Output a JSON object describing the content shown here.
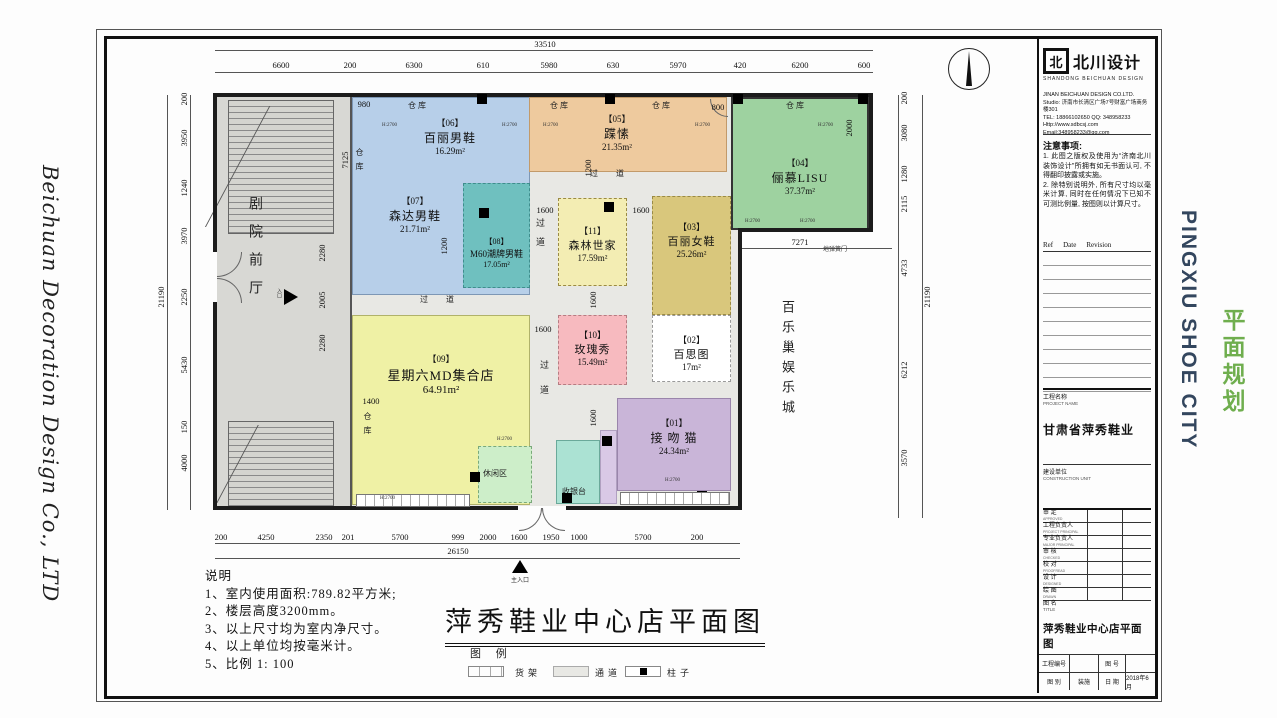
{
  "side_left": {
    "company": "Beichuan Decoration Design Co., LTD"
  },
  "side_right": {
    "city": "PINGXIU SHOE CITY",
    "city_color": "#33465e",
    "plan": "平面规划",
    "plan_color": "#6fae4e"
  },
  "titleblock": {
    "logo_glyph": "北",
    "logo_name": "北川设计",
    "logo_sub": "SHANDONG BEICHUAN DESIGN",
    "address": [
      "JINAN BEICHUAN DESIGN CO.LTD.",
      "Studio: 济南市长清区广场7号财富广场商务楼301",
      "TEL: 18866102650   QQ: 348958233",
      "Http://www.sdbcsj.com",
      "Email:348958233@qq.com"
    ],
    "caution_title": "注意事项:",
    "caution_1": "1. 此图之版权及使用为“济南北川装饰设计”所拥有如无书面认可, 不得翻印披露或实施。",
    "caution_2": "2. 除特别说明外, 所有尺寸均以毫米计算, 同时在任何情况下已知不可测比例量, 按图则以计算尺寸。",
    "rev_ref": "Ref",
    "rev_date": "Date",
    "rev_revision": "Revision",
    "project_label": "工程名称",
    "project_label_en": "PROJECT NAME",
    "project_name": "甘肃省萍秀鞋业",
    "client_label": "建设单位",
    "client_label_en": "CONSTRUCTION UNIT",
    "rows": [
      {
        "label": "审  定",
        "en": "APPROVED"
      },
      {
        "label": "工程负责人",
        "en": "PROJECT PRINCIPAL"
      },
      {
        "label": "专业负责人",
        "en": "MAJOR PRINCIPAL"
      },
      {
        "label": "审  核",
        "en": "CHECKED"
      },
      {
        "label": "校  对",
        "en": "PROOFREAD"
      },
      {
        "label": "设  计",
        "en": "DESIGNED"
      },
      {
        "label": "绘  图",
        "en": "DRAWN"
      }
    ],
    "fig_label": "图 名",
    "fig_label_en": "TITLE",
    "fig_name": "萍秀鞋业中心店平面图",
    "proj_no_label": "工程编号",
    "fig_no_label": "图 号",
    "cat_label": "图 别",
    "cat_value": "装施",
    "date_label": "日 期",
    "date_value": "2018年6月"
  },
  "plan": {
    "rooms": [
      {
        "no": "【01】",
        "name": "接 吻 猫",
        "area": "24.34m²",
        "color": "#c9b5d8"
      },
      {
        "no": "【02】",
        "name": "百思图",
        "area": "17m²",
        "color": "#ffffff"
      },
      {
        "no": "【03】",
        "name": "百丽女鞋",
        "area": "25.26m²",
        "color": "#d9c77c"
      },
      {
        "no": "【04】",
        "name": "俪慕LISU",
        "area": "37.37m²",
        "color": "#9ed2a0"
      },
      {
        "no": "【05】",
        "name": "蹀愫",
        "area": "21.35m²",
        "color": "#eeca9e"
      },
      {
        "no": "【06】",
        "name": "百丽男鞋",
        "area": "16.29m²",
        "color": "#b7cfe9"
      },
      {
        "no": "【07】",
        "name": "森达男鞋",
        "area": "21.71m²",
        "color": "#b7cfe9"
      },
      {
        "no": "【08】",
        "name": "M60潮牌男鞋",
        "area": "17.05m²",
        "color": "#6fc0bf"
      },
      {
        "no": "【09】",
        "name": "星期六MD集合店",
        "area": "64.91m²",
        "color": "#eff1a5"
      },
      {
        "no": "【10】",
        "name": "玫瑰秀",
        "area": "15.49m²",
        "color": "#f7babf"
      },
      {
        "no": "【11】",
        "name": "森林世家",
        "area": "17.59m²",
        "color": "#f3edb3"
      }
    ],
    "labels": {
      "warehouse": "仓库",
      "aisle": "过  道",
      "aisle_v": "过道",
      "hall": "剧院前厅",
      "entry": "入口",
      "main_entry": "主入口",
      "outside": "百乐巢娱乐城",
      "rest": "休闲区",
      "cashier": "收银台",
      "door": "地弹簧门",
      "height": "H:2700"
    },
    "dims": {
      "top_total": "33510",
      "top": [
        "6600",
        "200",
        "6300",
        "610",
        "5980",
        "630",
        "5970",
        "420",
        "6200",
        "600"
      ],
      "bottom_total": "26150",
      "bottom": [
        "200",
        "4250",
        "2350",
        "201",
        "5700",
        "999",
        "2000",
        "1600",
        "1950",
        "1000",
        "5700",
        "200"
      ],
      "left_total": "21190",
      "left": [
        "200",
        "3950",
        "1240",
        "3970",
        "2250",
        "5430",
        "150",
        "4000"
      ],
      "right_total": "21190",
      "right": [
        "200",
        "3080",
        "1280",
        "2115",
        "4733",
        "6212",
        "3570"
      ],
      "inner": {
        "w980": "980",
        "w7125": "7125",
        "w2280": "2280",
        "w2005": "2005",
        "w1200": "1200",
        "w1600": "1600",
        "w1400": "1400",
        "w800": "800",
        "w2000": "2000",
        "w7271": "7271"
      }
    }
  },
  "caption": {
    "notes_title": "说明",
    "notes": [
      "1、室内使用面积:789.82平方米;",
      "2、楼层高度3200mm。",
      "3、以上尺寸均为室内净尺寸。",
      "4、以上单位均按毫米计。",
      "5、比例  1: 100"
    ],
    "title": "萍秀鞋业中心店平面图",
    "legend_title": "图 例",
    "legend_shelf": "货架",
    "legend_aisle": "通道",
    "legend_column": "柱子"
  }
}
